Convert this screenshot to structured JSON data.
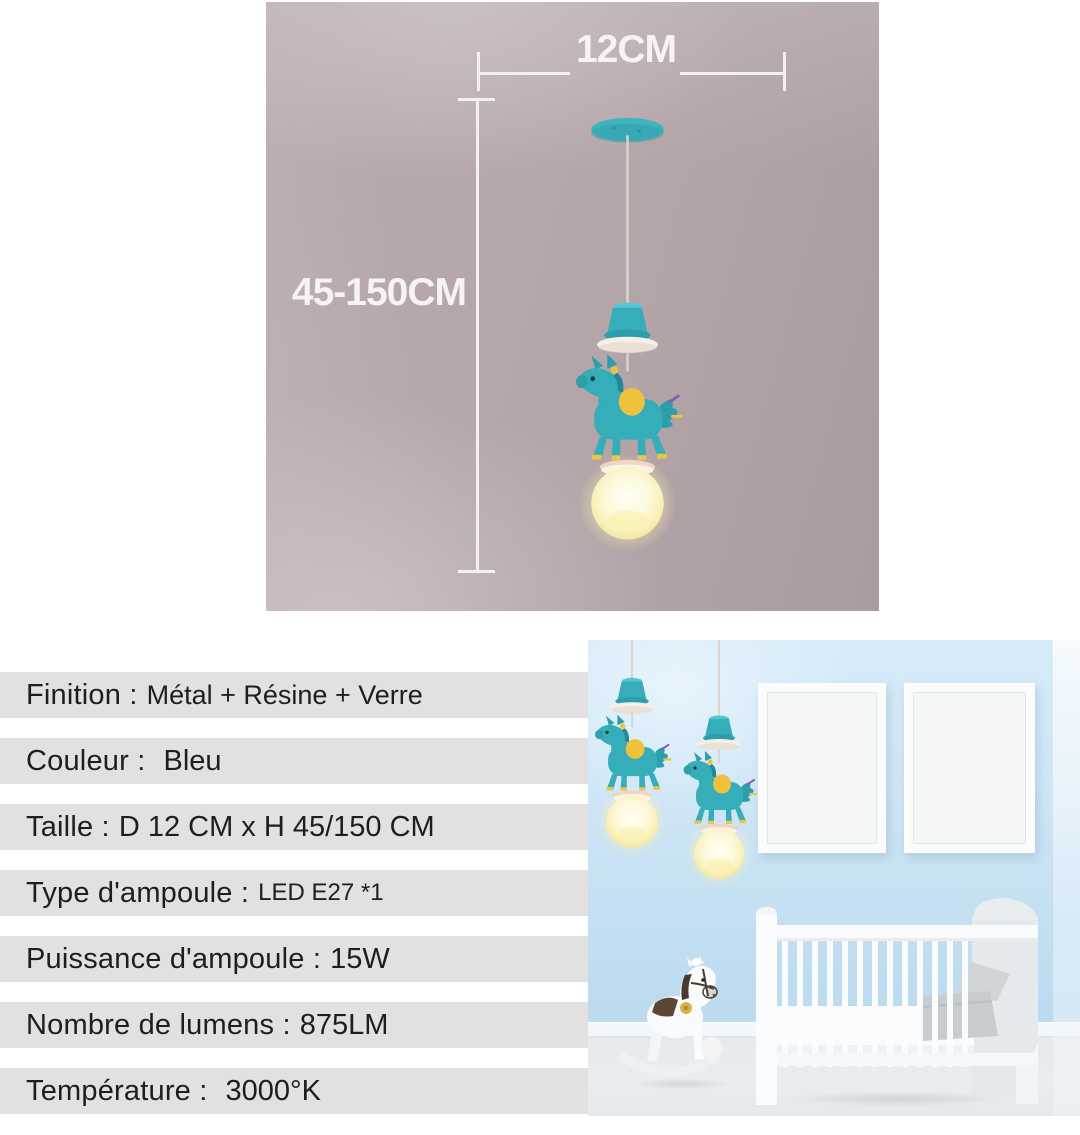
{
  "dimensions": {
    "width_label": "12CM",
    "height_label": "45-150CM"
  },
  "specs": [
    {
      "label": "Finition :",
      "value": "Métal + Résine + Verre"
    },
    {
      "label": "Couleur :",
      "value": "Bleu"
    },
    {
      "label": "Taille :",
      "value": "D 12 CM x H 45/150 CM"
    },
    {
      "label": "Type d'ampoule :",
      "value": "LED E27 *1"
    },
    {
      "label": "Puissance d'ampoule :",
      "value": "15W"
    },
    {
      "label": "Nombre de lumens :",
      "value": "875LM"
    },
    {
      "label": "Température :",
      "value": "3000°K"
    }
  ],
  "colors": {
    "lamp_teal": "#35aeba",
    "saddle_yellow": "#f0c23c",
    "glow_yellow": "#fdf6c9",
    "spec_bar_gray": "#e2e1df",
    "spec_text": "#1e1e1e",
    "wall_mauve": "#b3a5a8",
    "wall_blue": "#cde5f5",
    "dimension_line_white": "#f3f0ef"
  }
}
